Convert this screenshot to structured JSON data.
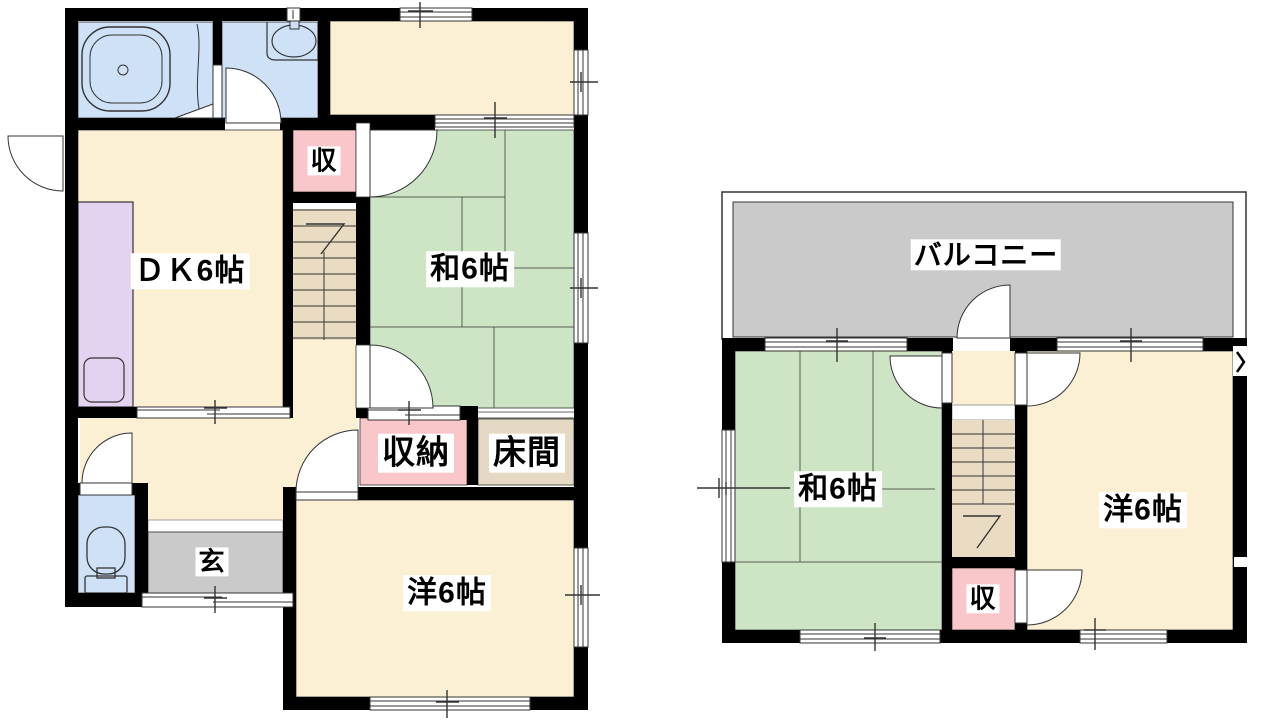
{
  "document": {
    "type": "floor-plan",
    "description": "2-story Japanese house floor plan"
  },
  "palette": {
    "wall": "#000000",
    "outline": "#333333",
    "room_cream": "#FBF0D4",
    "tatami_green": "#CEE5C5",
    "water_blue": "#CEE1F6",
    "kitchen_purple": "#E3D3F0",
    "closet_pink": "#F9C6CA",
    "balcony_gray": "#CACACA",
    "stair_tan": "#EADCC2",
    "tokonoma_tan": "#E6D9C3"
  },
  "floor1": {
    "labels": {
      "dk": "ＤＫ6帖",
      "washitsu": "和6帖",
      "youshitsu": "洋6帖",
      "closet": "収",
      "storage": "収納",
      "tokonoma": "床間",
      "entrance": "玄"
    }
  },
  "floor2": {
    "labels": {
      "balcony": "バルコニー",
      "washitsu": "和6帖",
      "youshitsu": "洋6帖",
      "closet": "収"
    }
  }
}
